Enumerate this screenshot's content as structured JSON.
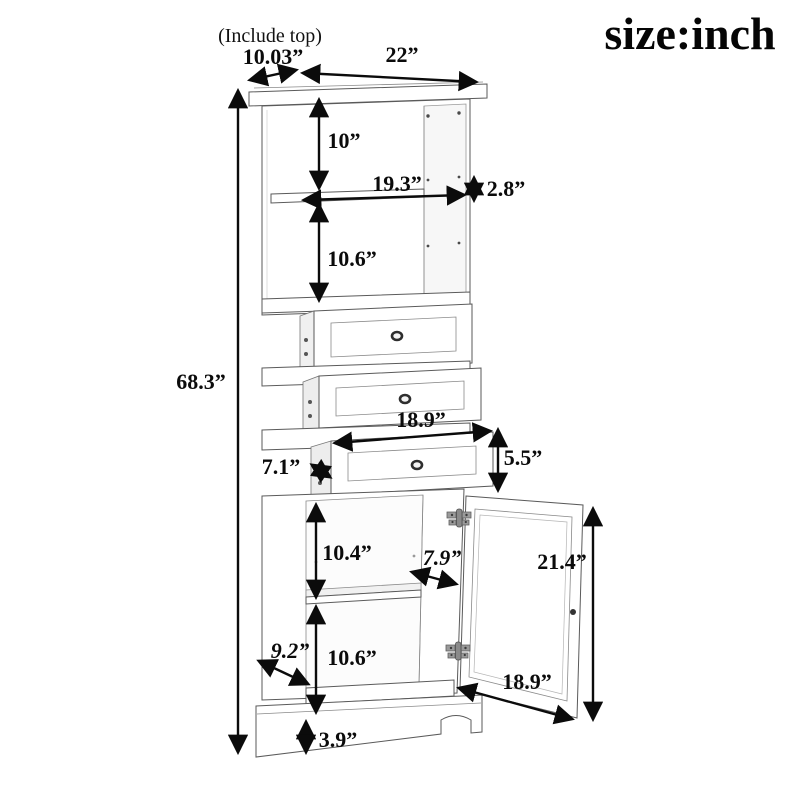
{
  "header": {
    "title": "size:inch",
    "note": "(Include top)"
  },
  "labels": {
    "top_depth": "10.03”",
    "top_width": "22”",
    "overall_height": "68.3”",
    "top_shelf_height": "10”",
    "interior_width": "19.3”",
    "right_gap": "2.8”",
    "middle_shelf_height": "10.6”",
    "drawer_width": "18.9”",
    "drawer_depth_side": "7.1”",
    "drawer_height": "5.5”",
    "lower_shelf_height": "10.4”",
    "shelf_depth": "7.9”",
    "door_height": "21.4”",
    "bottom_depth": "9.2”",
    "bottom_shelf_height": "10.6”",
    "door_width": "18.9”",
    "base_height": "3.9”"
  },
  "colors": {
    "dimension": "#0b0b0b",
    "furniture_line": "#5a5a5a",
    "background": "#ffffff"
  }
}
